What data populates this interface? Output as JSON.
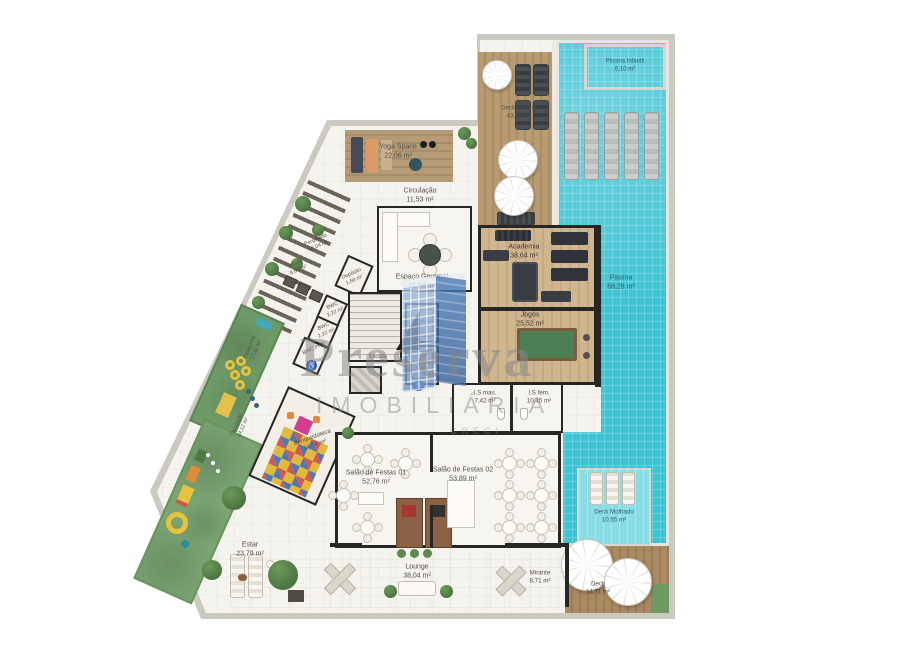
{
  "rooms": {
    "yoga": {
      "name": "Yoga Space",
      "area": "22,06 m²"
    },
    "circulacao_topo": {
      "name": "Circulação",
      "area": "11,53 m²"
    },
    "deck_piscina": {
      "name": "Deck Piscina",
      "area": "43,65 m²"
    },
    "piscina_infantil": {
      "name": "Piscina Infantil",
      "area": "6,10 m²"
    },
    "piscina": {
      "name": "Piscina",
      "area": "68,28 m²"
    },
    "academia": {
      "name": "Academia",
      "area": "38,64 m²"
    },
    "jogos": {
      "name": "Jogos",
      "area": "25,52 m²"
    },
    "espaco_gourmet": {
      "name": "Espaço Gourmet",
      "area": "31,60 m²"
    },
    "deposito": {
      "name": "Depósito",
      "area": "1,68 m²"
    },
    "bwc_1": {
      "name": "BWC",
      "area": "2,22 m²"
    },
    "bwc_2": {
      "name": "BWC",
      "area": "2,22 m²"
    },
    "bwc_pne": {
      "name": "BWC PNE",
      "area": ""
    },
    "escada": {
      "name": "Escada",
      "area": ""
    },
    "elevador_1": {
      "name": "Elevador Social",
      "area": ""
    },
    "elevador_2": {
      "name": "Elevador Social",
      "area": ""
    },
    "is_mas": {
      "name": "I.S mas.",
      "area": "7,42 m²"
    },
    "is_fem": {
      "name": "I.S fem.",
      "area": "10,45 m²"
    },
    "pergolado": {
      "name": "Pergolado",
      "area": "15,04 m²"
    },
    "horta": {
      "name": "Horta",
      "area": "8,89 m²"
    },
    "espaco_fit": {
      "name": "Espaço Fit",
      "area": "17,39 m²"
    },
    "circulacao_lateral": {
      "name": "Circulação",
      "area": "34,12 m²"
    },
    "brinquedoteca": {
      "name": "Brinquedoteca",
      "area": "16,74 m²"
    },
    "salao_1": {
      "name": "Salão de Festas 01",
      "area": "52,76 m²"
    },
    "salao_2": {
      "name": "Salão de Festas 02",
      "area": "53,89 m²"
    },
    "estar": {
      "name": "Estar",
      "area": "23,79 m²"
    },
    "lounge": {
      "name": "Lounge",
      "area": "38,04 m²"
    },
    "mirante": {
      "name": "Mirante",
      "area": "8,71 m²"
    },
    "deck_molhado": {
      "name": "Deck Molhado",
      "area": "10,55 m²"
    },
    "deck_inferior": {
      "name": "Deck",
      "area": "14,71 m²"
    }
  },
  "watermark": {
    "brand": "Preserva",
    "subtitle": "IMOBILIÁRIA",
    "registry": "CRECI"
  },
  "palette": {
    "pool": "#3cc4d4",
    "wood": "#b99b73",
    "grass": "#7ba472",
    "wall": "#262624",
    "watermark_blue": "#3b6cab",
    "accent_yellow": "#e5c33c"
  }
}
